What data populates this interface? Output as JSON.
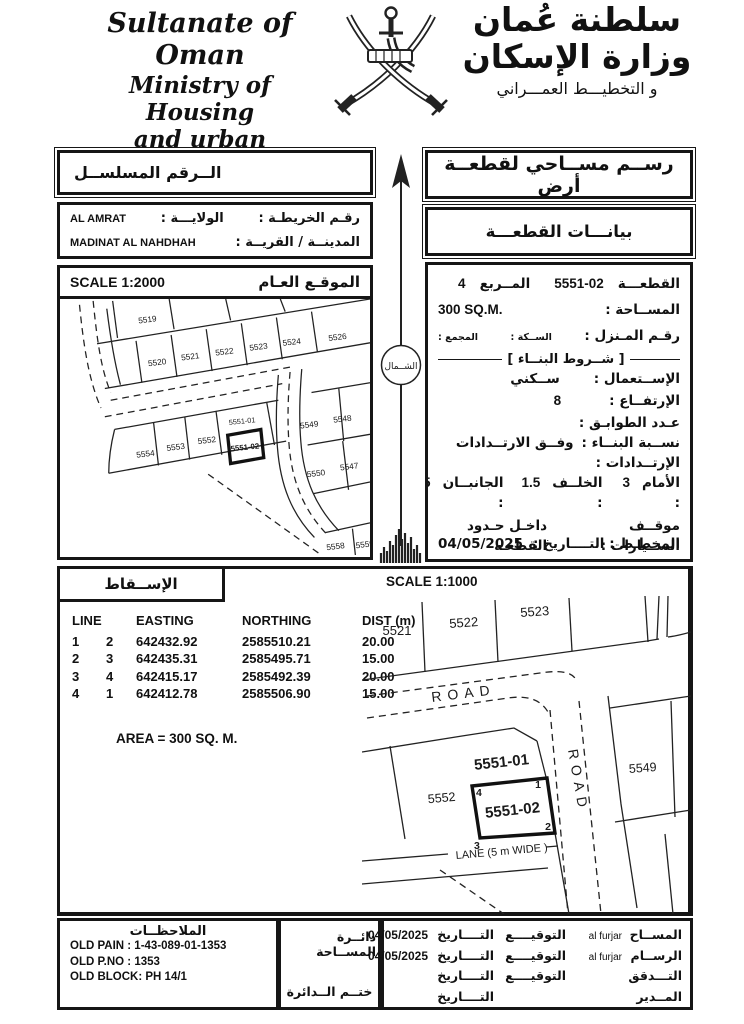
{
  "header": {
    "en": {
      "line1": "Sultanate of Oman",
      "line2": "Ministry of Housing",
      "line3": "and urban planning"
    },
    "ar": {
      "line1": "سلطنة عُمان",
      "line2": "وزارة الإسكان",
      "line3": "و التخطيـــط العمـــراني"
    }
  },
  "serial": {
    "title": "الــرقم المسلســل"
  },
  "location": {
    "map_no_label": "رقـم الخريطـة :",
    "wilaya_label": "الولايـــة :",
    "wilaya_value": "AL AMRAT",
    "city_label": "المدينــة / القريــة :",
    "city_value": "MADINAT AL NAHDHAH"
  },
  "site_map": {
    "title": "الموقـع العـام",
    "scale": "SCALE 1:2000",
    "plots": [
      "5519",
      "5520",
      "5521",
      "5522",
      "5523",
      "5524",
      "5526",
      "5554",
      "5553",
      "5552",
      "5551-01",
      "5551-02",
      "5549",
      "5548",
      "5550",
      "5547",
      "5558",
      "5559"
    ]
  },
  "north": {
    "label": "الشــمال"
  },
  "doc": {
    "title": "رســم مســاحي لقطعــة أرض",
    "section": "بيانـــات القطعـــة"
  },
  "plot": {
    "plot_label": "القطعـــة",
    "plot_value": "5551-02",
    "square_label": "المــربع",
    "square_value": "4",
    "area_label": "المســاحة :",
    "area_value": "300 SQ.M.",
    "house_label": "رقـم المـنزل :",
    "street_label": "الســكة :",
    "complex_label": "المجمع :",
    "conditions_title": "[ شــروط البنــاء ]",
    "use_label": "الإســتعمال :",
    "use_value": "ســكني",
    "height_label": "الإرتفــاع :",
    "height_value": "8",
    "floors_label": "عـدد الطوابـق :",
    "ratio_label": "نســبة البنــاء :",
    "ratio_value": "وفــق الارتــدادات",
    "setbacks_label": "الإرتــدادات :",
    "front_label": "الأمام :",
    "front_value": "3",
    "back_label": "الخلــف :",
    "back_value": "1.5",
    "sides_label": "الجانبــان :",
    "sides_value": "1.5",
    "parking_label": "موقــف الســيارات :",
    "parking_value": "داخـل حـدود القطعـه",
    "other_label": "شروط أخرى",
    "planner_label": "المخطـط :",
    "date_label": "التــــاريخ :",
    "date_value": "04/05/2025"
  },
  "projection": {
    "title": "الإســقاط",
    "scale": "SCALE 1:1000",
    "table": {
      "col_line": "LINE",
      "col_easting": "EASTING",
      "col_northing": "NORTHING",
      "col_dist": "DIST (m)",
      "rows": [
        [
          "1",
          "2",
          "642432.92",
          "2585510.21",
          "20.00"
        ],
        [
          "2",
          "3",
          "642435.31",
          "2585495.71",
          "15.00"
        ],
        [
          "3",
          "4",
          "642415.17",
          "2585492.39",
          "20.00"
        ],
        [
          "4",
          "1",
          "642412.78",
          "2585506.90",
          "15.00"
        ]
      ]
    },
    "area_note": "AREA = 300 SQ. M."
  },
  "detail_map": {
    "labels": [
      "5521",
      "5522",
      "5523",
      "5552",
      "5551-01",
      "5551-02",
      "5549"
    ],
    "road_h": "ROAD",
    "road_v": "ROAD",
    "lane": "LANE  (5 m WIDE )",
    "corners": [
      "1",
      "2",
      "3",
      "4"
    ]
  },
  "footer": {
    "notes_title": "الملاحظــات",
    "notes": [
      "OLD PAIN : 1-43-089-01-1353",
      "OLD P.NO : 1353",
      "OLD BLOCK: PH 14/1"
    ],
    "survey_dept": "دائــرة المســاحة",
    "dept_stamp": "ختــم الــدائرة",
    "sign_rows": [
      {
        "role": "المســاح",
        "name": "al furjar",
        "sig": "التوقيــــع",
        "date_label": "التــــاريخ",
        "date": "04/05/2025"
      },
      {
        "role": "الرســام",
        "name": "al furjar",
        "sig": "التوقيــــع",
        "date_label": "التــــاريخ",
        "date": "04/05/2025"
      },
      {
        "role": "التـــدقق",
        "name": "",
        "sig": "التوقيــــع",
        "date_label": "التــــاريخ",
        "date": ""
      },
      {
        "role": "المــدير",
        "name": "",
        "sig": "",
        "date_label": "التــــاريخ",
        "date": ""
      }
    ]
  }
}
